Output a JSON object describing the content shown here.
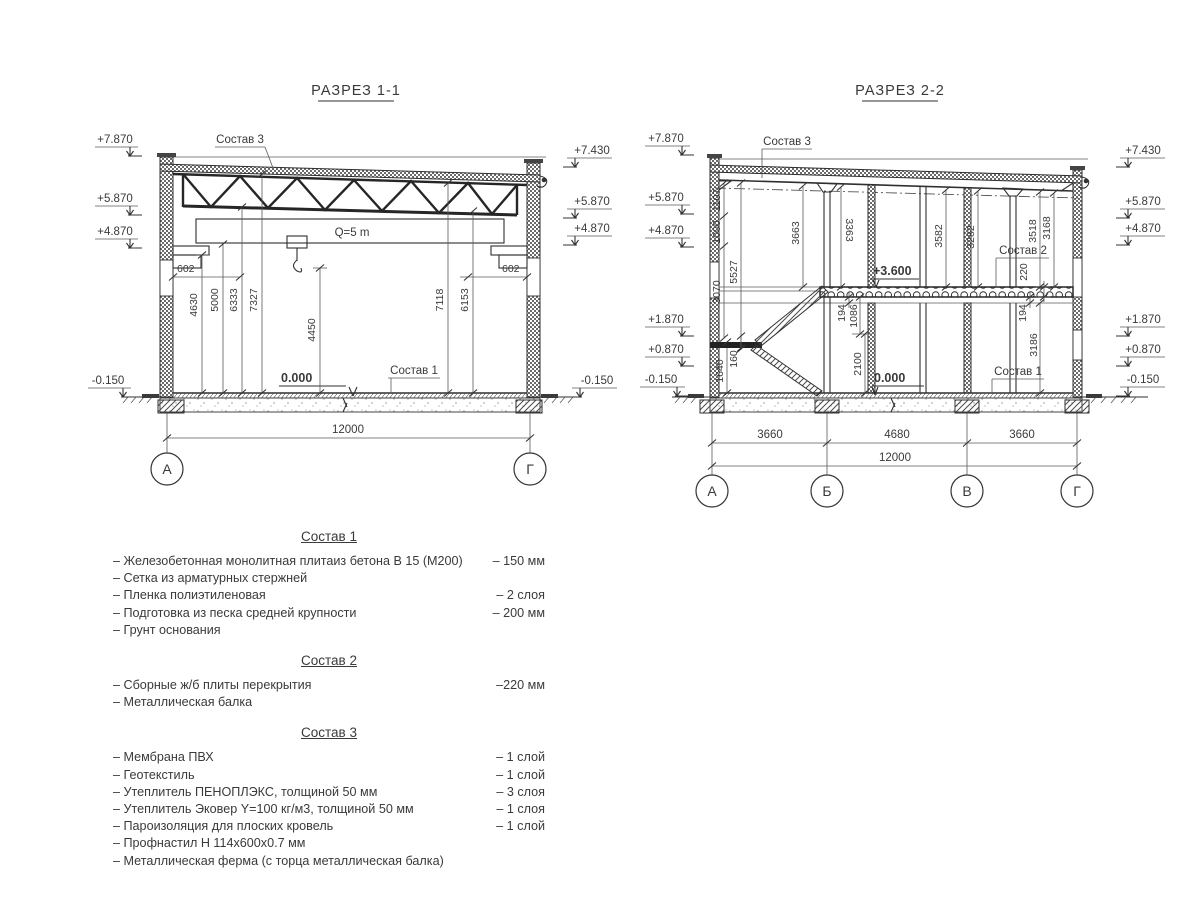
{
  "s1": {
    "title": "РАЗРЕЗ 1-1",
    "elev_left": [
      "+7.870",
      "+5.870",
      "+4.870",
      "-0.150"
    ],
    "elev_right": [
      "+7.430",
      "+5.870",
      "+4.870",
      "-0.150"
    ],
    "labels": {
      "sostav3": "Состав 3",
      "sostav1": "Состав 1",
      "crane": "Q=5 m",
      "zero": "0.000",
      "d602": "602",
      "span": "12000"
    },
    "vdims": [
      "4630",
      "5000",
      "6333",
      "7327",
      "4450",
      "7118",
      "6153"
    ],
    "axes": [
      "А",
      "Г"
    ]
  },
  "s2": {
    "title": "РАЗРЕЗ 2-2",
    "elev_left": [
      "+7.870",
      "+5.870",
      "+4.870",
      "+1.870",
      "+0.870",
      "-0.150"
    ],
    "elev_right": [
      "+7.430",
      "+5.870",
      "+4.870",
      "+1.870",
      "+0.870",
      "-0.150"
    ],
    "labels": {
      "sostav3": "Состав 3",
      "sostav2": "Состав 2",
      "sostav1": "Состав 1",
      "level": "+3.600",
      "zero": "0.000",
      "slab": "220",
      "span": "12000"
    },
    "wall_dims": [
      "1107",
      "1000",
      "3070",
      "5527"
    ],
    "room_dims": [
      "3663",
      "3363",
      "3582",
      "3282",
      "3518",
      "3168"
    ],
    "under_left": [
      "194",
      "1086",
      "2100"
    ],
    "under_right": [
      "194",
      "3186"
    ],
    "stair_dims": [
      "1640",
      "160"
    ],
    "bottom_dims": [
      "3660",
      "4680",
      "3660"
    ],
    "axes": [
      "А",
      "Б",
      "В",
      "Г"
    ]
  },
  "compositions": [
    {
      "title": "Состав 1",
      "items": [
        {
          "name": "– Железобетонная  монолитная плитаиз бетона В 15 (М200)",
          "qty": "– 150 мм"
        },
        {
          "name": "– Сетка из арматурных стержней",
          "qty": ""
        },
        {
          "name": "– Пленка полиэтиленовая",
          "qty": "– 2 слоя"
        },
        {
          "name": "– Подготовка из песка средней крупности",
          "qty": "– 200 мм"
        },
        {
          "name": "– Грунт основания",
          "qty": ""
        }
      ]
    },
    {
      "title": "Состав 2",
      "items": [
        {
          "name": "– Сборные ж/б плиты перекрытия",
          "qty": "–220 мм"
        },
        {
          "name": "– Металлическая балка",
          "qty": ""
        }
      ]
    },
    {
      "title": "Состав 3",
      "items": [
        {
          "name": "– Мембрана ПВХ",
          "qty": "– 1 слой"
        },
        {
          "name": "– Геотекстиль",
          "qty": "– 1 слой"
        },
        {
          "name": "– Утеплитель ПЕНОПЛЭКС, толщиной 50 мм",
          "qty": "– 3 слоя"
        },
        {
          "name": "– Утеплитель Эковер Y=100 кг/м3, толщиной 50 мм",
          "qty": "– 1 слоя"
        },
        {
          "name": "– Пароизоляция для плоских кровель",
          "qty": "– 1 слой"
        },
        {
          "name": "– Профнастил Н 114х600х0.7 мм",
          "qty": ""
        },
        {
          "name": "– Металлическая ферма (с торца металлическая балка)",
          "qty": ""
        }
      ]
    }
  ]
}
